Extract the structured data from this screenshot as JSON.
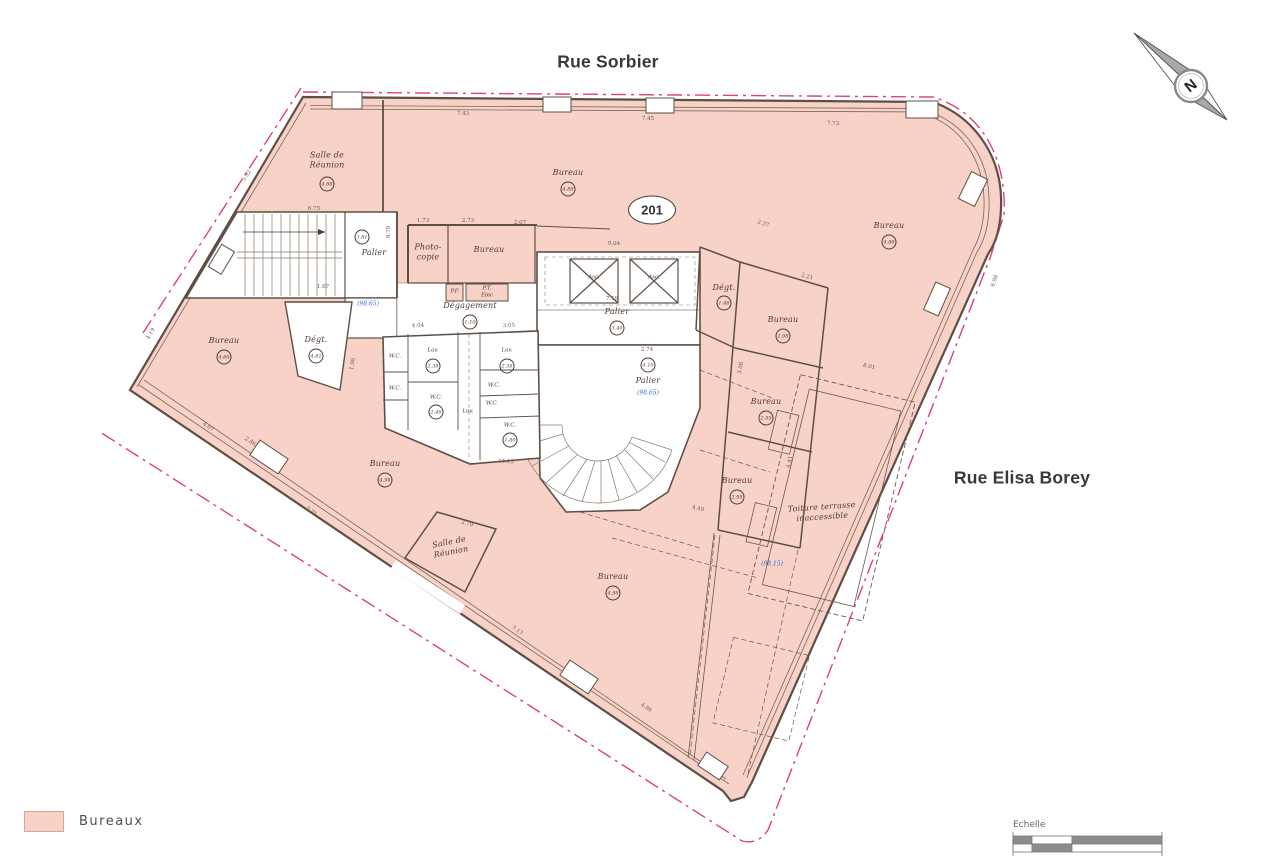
{
  "streets": {
    "top": "Rue Sorbier",
    "right": "Rue Elisa Borey"
  },
  "unit": {
    "number": "201"
  },
  "compass": {
    "north_letter": "N"
  },
  "legend": {
    "items": [
      {
        "label": "Bureaux",
        "color": "#f9d2c7"
      }
    ]
  },
  "scalebar": {
    "label": "Echelle"
  },
  "colors": {
    "bureaux_fill": "#f8d2c7",
    "wall": "#5e4f46",
    "boundary_red": "#e0407a",
    "level_blue": "#2f6bd8"
  },
  "levels": {
    "stair_nw": "(98.65)",
    "palier_main": "(98.65)",
    "terrace": "(98.15)"
  },
  "rooms": {
    "salle_reunion_nw": {
      "label": "Salle de\nRéunion",
      "value": "4.86"
    },
    "bureau_top": {
      "label": "Bureau",
      "value": "4.88"
    },
    "bureau_ne": {
      "label": "Bureau",
      "value": "4.88"
    },
    "palier_nw": {
      "label": "Palier",
      "value": "3.81"
    },
    "photocopie": {
      "label": "Photo-\ncopie"
    },
    "bureau_copy": {
      "label": "Bureau"
    },
    "pf": {
      "label": "P.F."
    },
    "pt_elec": {
      "label": "P.T.\nElec"
    },
    "degagement": {
      "label": "Dégagement",
      "value": "1.10"
    },
    "asc1": {
      "label": "Asc."
    },
    "asc2": {
      "label": "Asc."
    },
    "palier_center": {
      "label": "Palier",
      "value": "3.40"
    },
    "degt_right": {
      "label": "Dégt.",
      "value": "1.46"
    },
    "bureau_r1": {
      "label": "Bureau",
      "value": "2.98"
    },
    "bureau_r2": {
      "label": "Bureau",
      "value": "2.95"
    },
    "bureau_r3": {
      "label": "Bureau",
      "value": "2.95"
    },
    "bureau_left": {
      "label": "Bureau",
      "value": "4.60"
    },
    "degt_left": {
      "label": "Dégt.",
      "value": "4.82"
    },
    "wc_nw": {
      "label": "W.C."
    },
    "lav_nw": {
      "label": "Lav.",
      "value": "2.38"
    },
    "wc_w": {
      "label": "W.C."
    },
    "wc_c": {
      "label": "W.C.",
      "value": "2.48"
    },
    "lav_c": {
      "label": "Lav."
    },
    "lav_e": {
      "label": "Lav.",
      "value": "2.38"
    },
    "wc_e": {
      "label": "W.C."
    },
    "wc_e2": {
      "label": "W.C."
    },
    "wc_s": {
      "label": "W.C.",
      "value": "1.80"
    },
    "palier_main": {
      "label": "Palier",
      "value": "4.10"
    },
    "bureau_sw": {
      "label": "Bureau",
      "value": "4.98"
    },
    "salle_reunion_s": {
      "label": "Salle de\nRéunion"
    },
    "bureau_s": {
      "label": "Bureau",
      "value": "4.98"
    },
    "toiture": {
      "label": "Toiture terrasse\ninaccessible"
    }
  },
  "dims": {
    "d1": "7.43",
    "d2": "7.45",
    "d3": "7.73",
    "d4": "5.92",
    "d5": "6.75",
    "d6": "1.73",
    "d7": "2.73",
    "d8": "2.07",
    "d9": "9.04",
    "d10": "2.37",
    "d11": "2.21",
    "d12": "1.67",
    "d13": "7.19",
    "d14": "4.04",
    "d15": "3.05",
    "d16": "2.74",
    "d17": "1.98",
    "d18": "14.13",
    "d19": "8.01",
    "d20": "3.08",
    "d21": "4.41",
    "d22": "2.79",
    "d23": "7.71",
    "d24": "4.07",
    "d25": "2.86",
    "d26": "7.17",
    "d27": "4.86",
    "d28": "4.40",
    "d29": "4.19",
    "d30": "6.98",
    "d31": "8.79"
  }
}
